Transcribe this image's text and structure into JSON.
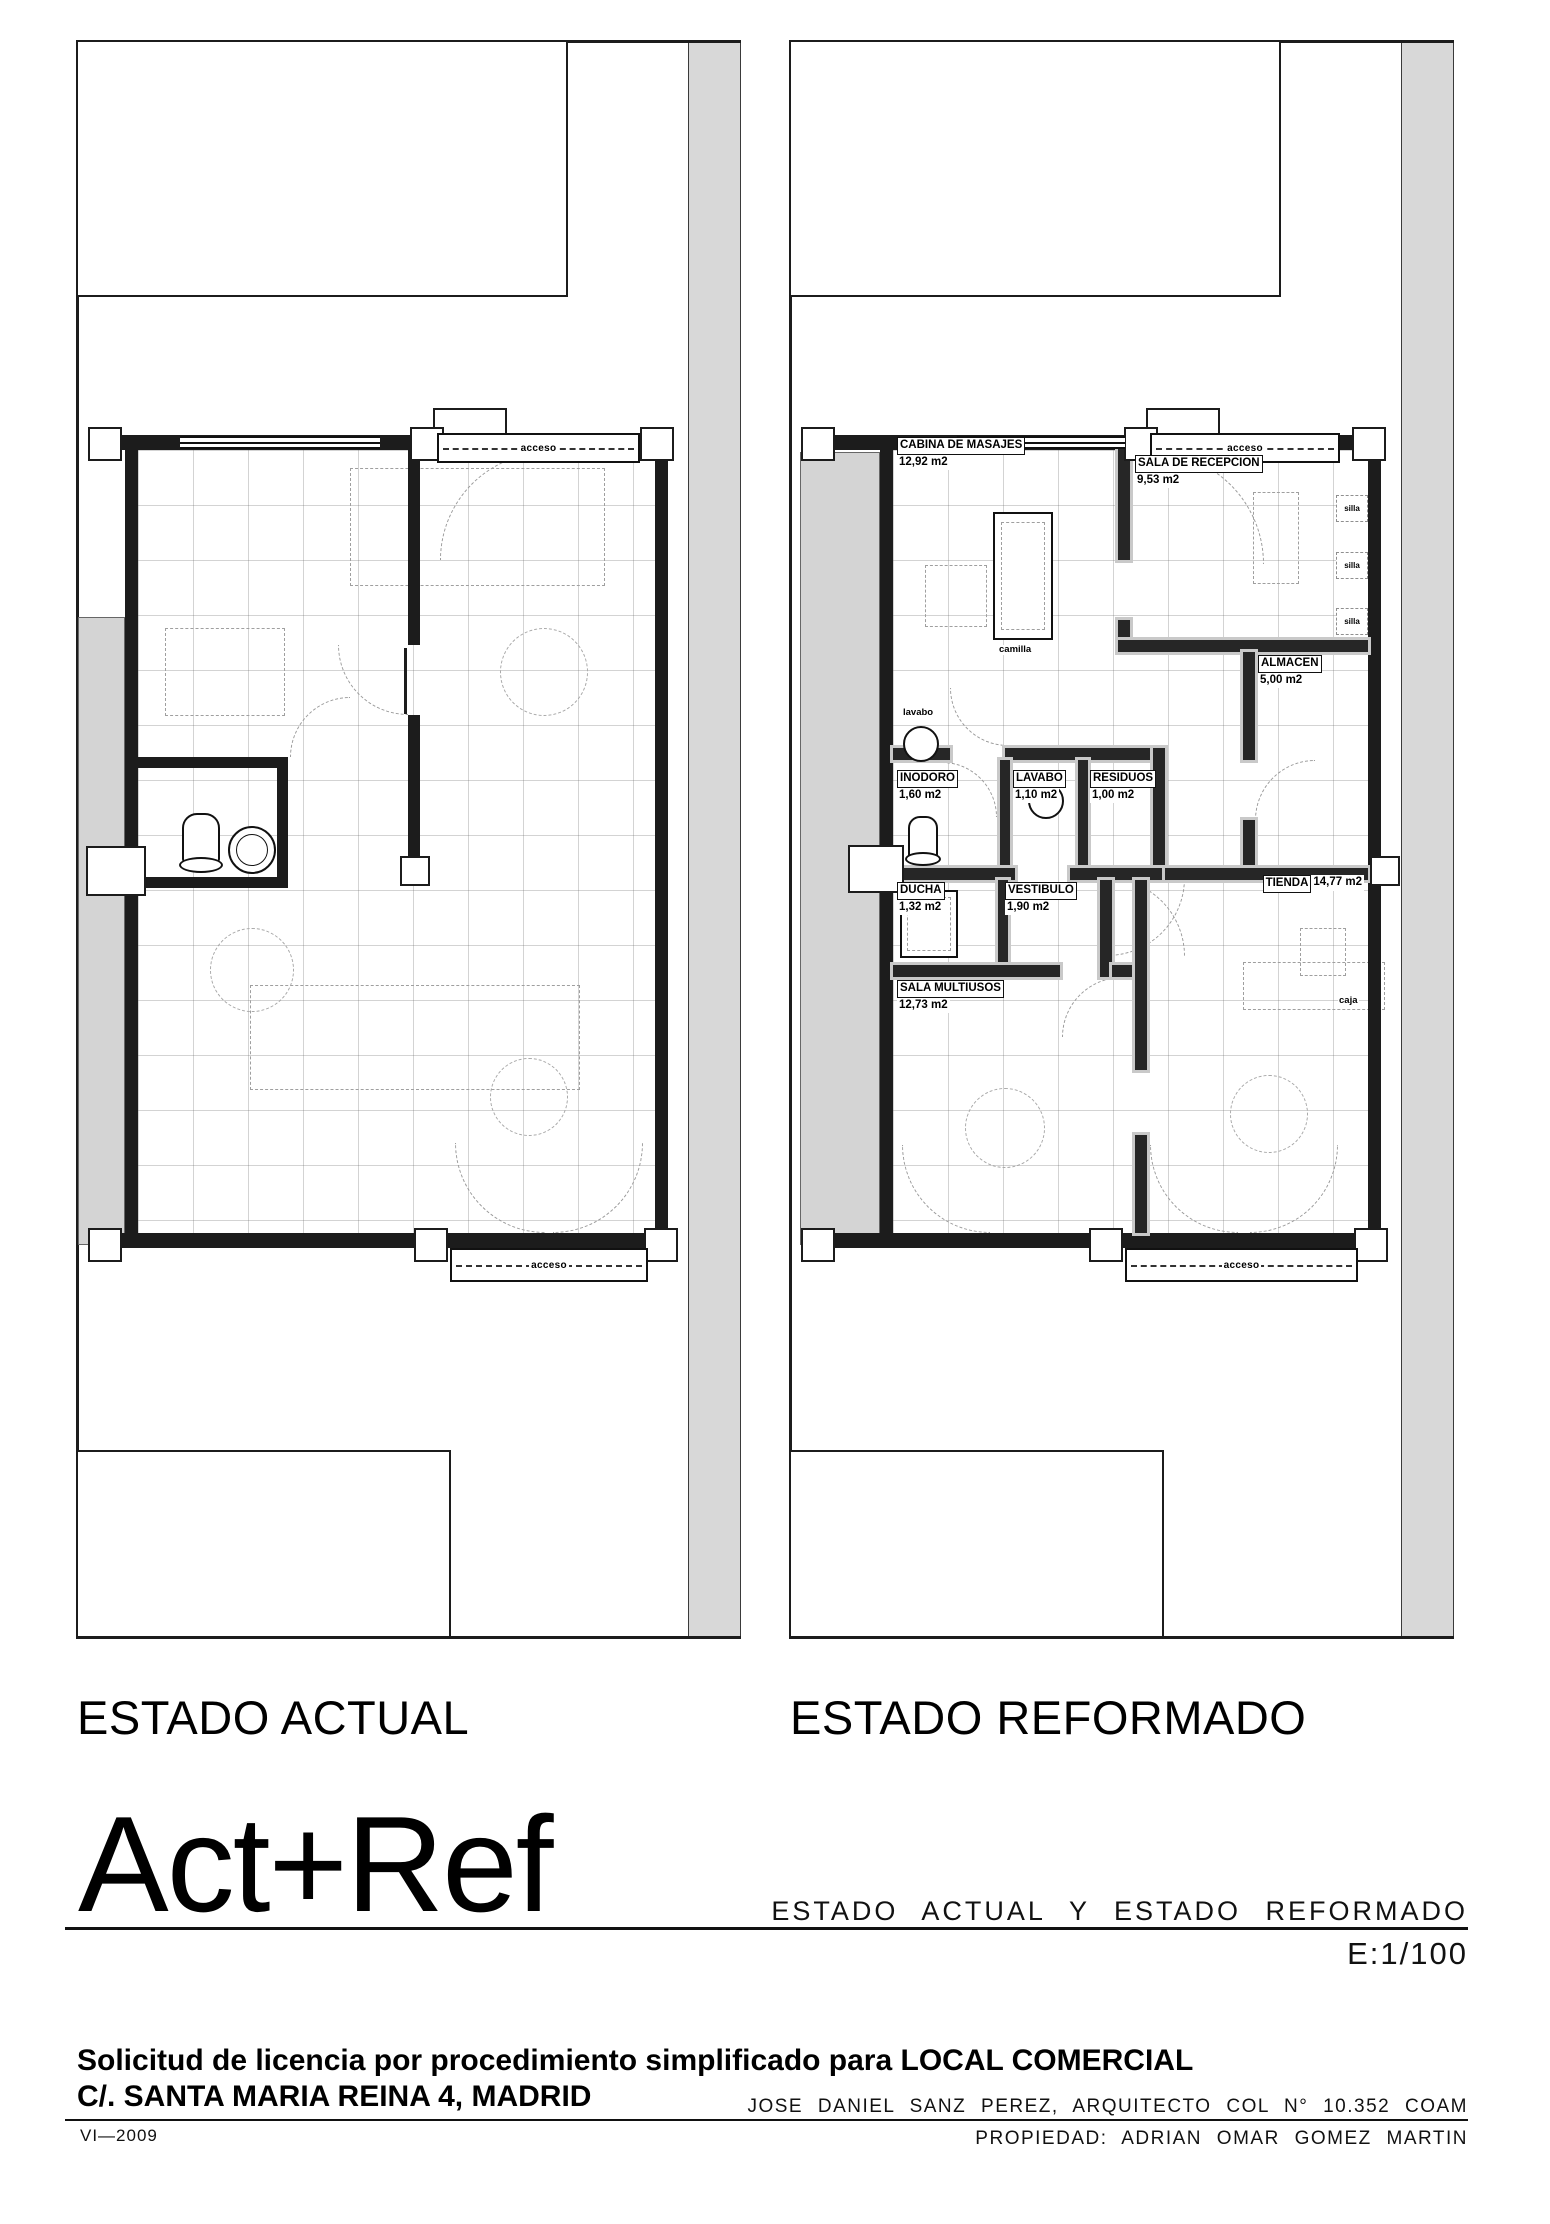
{
  "titles": {
    "left": "ESTADO ACTUAL",
    "right": "ESTADO REFORMADO",
    "big": "Act+Ref",
    "drawing_name": "ESTADO ACTUAL Y ESTADO REFORMADO",
    "scale": "E:1/100"
  },
  "titleblock": {
    "line1": "Solicitud de licencia por procedimiento simplificado para LOCAL COMERCIAL",
    "line2": "C/. SANTA MARIA REINA 4, MADRID",
    "architect": "JOSE DANIEL SANZ PEREZ, ARQUITECTO COL N° 10.352 COAM",
    "date": "VI—2009",
    "property": "PROPIEDAD: ADRIAN OMAR GOMEZ MARTIN"
  },
  "labels": {
    "acceso": "acceso",
    "lavabo_small": "lavabo",
    "camilla": "camilla",
    "silla": "silla",
    "caja": "caja"
  },
  "rooms": [
    {
      "name": "CABINA DE MASAJES",
      "area": "12,92 m2"
    },
    {
      "name": "SALA DE RECEPCION",
      "area": "9,53 m2"
    },
    {
      "name": "ALMACEN",
      "area": "5,00 m2"
    },
    {
      "name": "INODORO",
      "area": "1,60 m2"
    },
    {
      "name": "LAVABO",
      "area": "1,10 m2"
    },
    {
      "name": "RESIDUOS",
      "area": "1,00 m2"
    },
    {
      "name": "DUCHA",
      "area": "1,32 m2"
    },
    {
      "name": "VESTIBULO",
      "area": "1,90 m2"
    },
    {
      "name": "SALA MULTIUSOS",
      "area": "12,73 m2"
    },
    {
      "name": "TIENDA",
      "area": "14,77 m2"
    }
  ],
  "colors": {
    "wall": "#1c1c1c",
    "site_gray": "#d8d8d8",
    "tile_line": "#6e6e6e",
    "dash": "#9b9b9b"
  }
}
